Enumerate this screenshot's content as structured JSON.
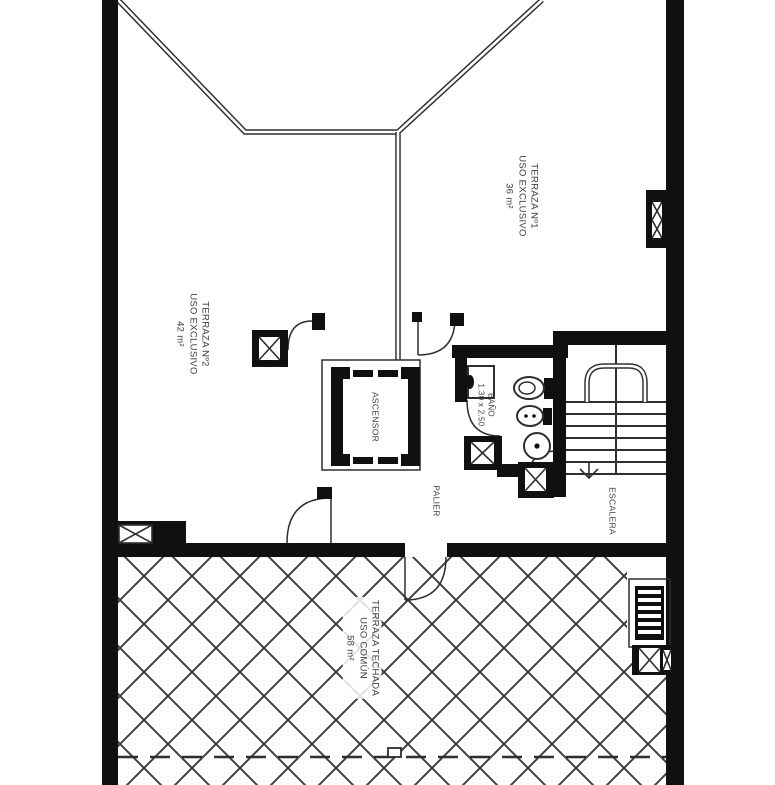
{
  "colors": {
    "wall": "#101010",
    "line": "#2e2e2e",
    "hatch": "#3e3e3e",
    "text": "#3c3c3c",
    "bg": "#ffffff"
  },
  "rooms": {
    "terraza1": {
      "name": "TERRAZA Nº1",
      "use": "USO EXCLUSIVO",
      "area": "36 m²"
    },
    "terraza2": {
      "name": "TERRAZA Nº2",
      "use": "USO EXCLUSIVO",
      "area": "42 m²"
    },
    "terrazaTechada": {
      "name": "TERRAZA TECHADA",
      "use": "USO COMÚN",
      "area": "58 m²"
    },
    "ascensor": {
      "name": "ASCENSOR"
    },
    "bano": {
      "name": "BAÑO",
      "dimensions": "1.30 x 2.50"
    },
    "palier": {
      "name": "PALIER"
    },
    "escalera": {
      "name": "ESCALERA"
    }
  }
}
